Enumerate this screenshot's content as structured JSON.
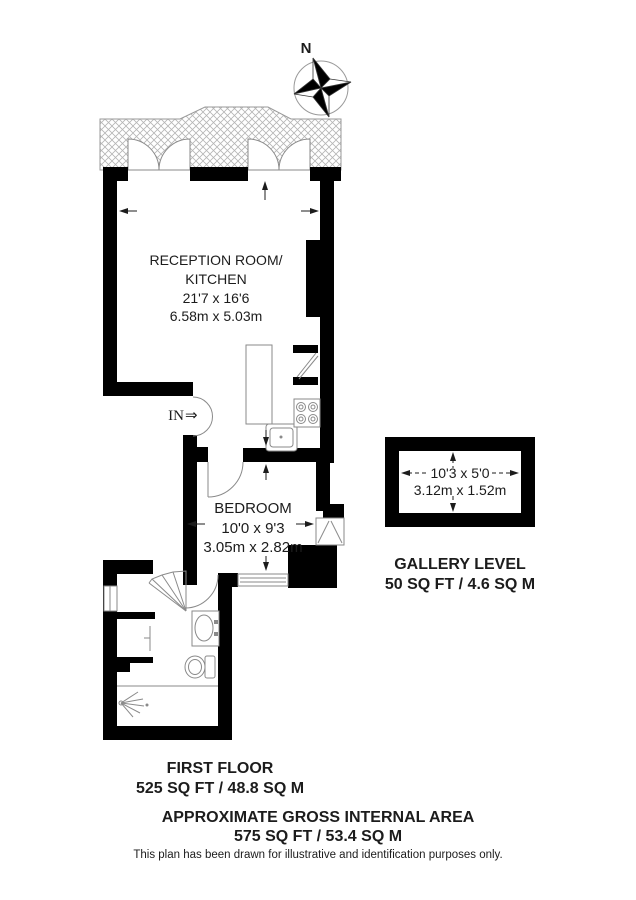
{
  "plan": {
    "compass": {
      "label": "N"
    },
    "entrance": {
      "label": "IN",
      "arrow": "⇒"
    },
    "reception": {
      "line1": "RECEPTION ROOM/",
      "line2": "KITCHEN",
      "dims_ft": "21'7 x 16'6",
      "dims_m": "6.58m x 5.03m"
    },
    "bedroom": {
      "name": "BEDROOM",
      "dims_ft": "10'0 x 9'3",
      "dims_m": "3.05m x 2.82m"
    },
    "gallery": {
      "dims_ft": "10'3 x 5'0",
      "dims_m": "3.12m x 1.52m",
      "title": "GALLERY LEVEL",
      "area": "50 SQ FT / 4.6 SQ M"
    },
    "first_floor": {
      "title": "FIRST FLOOR",
      "area": "525 SQ FT / 48.8 SQ M"
    },
    "footer": {
      "title": "APPROXIMATE GROSS INTERNAL AREA",
      "area": "575 SQ FT / 53.4 SQ M",
      "disclaimer": "This plan has been drawn for illustrative and identification purposes only."
    },
    "colors": {
      "wall": "#000000",
      "thin_line": "#8a8a8a",
      "hatch": "#b5b5b5"
    }
  }
}
